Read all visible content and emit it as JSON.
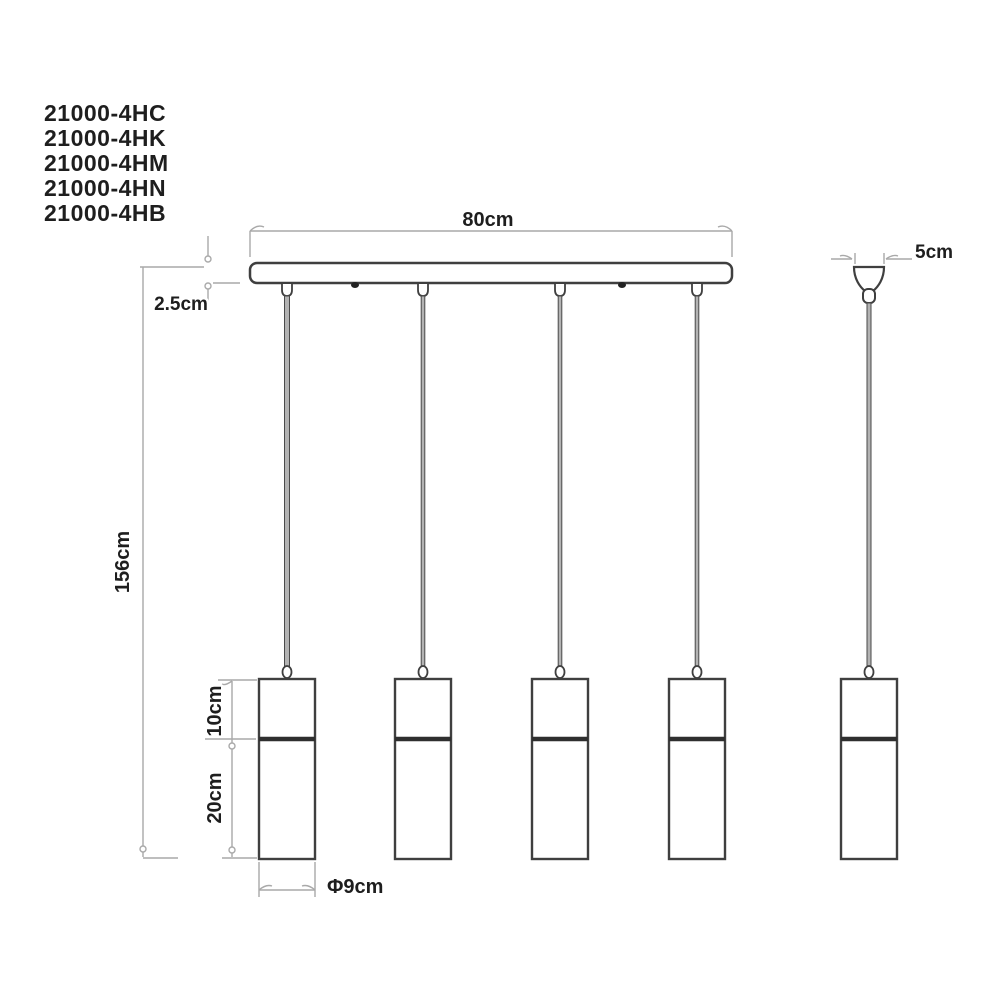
{
  "product_codes": [
    "21000-4HC",
    "21000-4HK",
    "21000-4HM",
    "21000-4HN",
    "21000-4HB"
  ],
  "dimensions": {
    "bar_width": "80cm",
    "bar_thickness": "2.5cm",
    "drop_height": "156cm",
    "shade_top_section": "10cm",
    "shade_bottom_section": "20cm",
    "shade_diameter": "Φ9cm",
    "canopy_width": "5cm"
  },
  "colors": {
    "drawing_line": "#3f3f3f",
    "divider_line": "#2f2f2f",
    "dimension_line": "#a9a9a9",
    "cord_fill": "#b3b3b3",
    "text": "#1e1e1e",
    "background": "#ffffff"
  }
}
